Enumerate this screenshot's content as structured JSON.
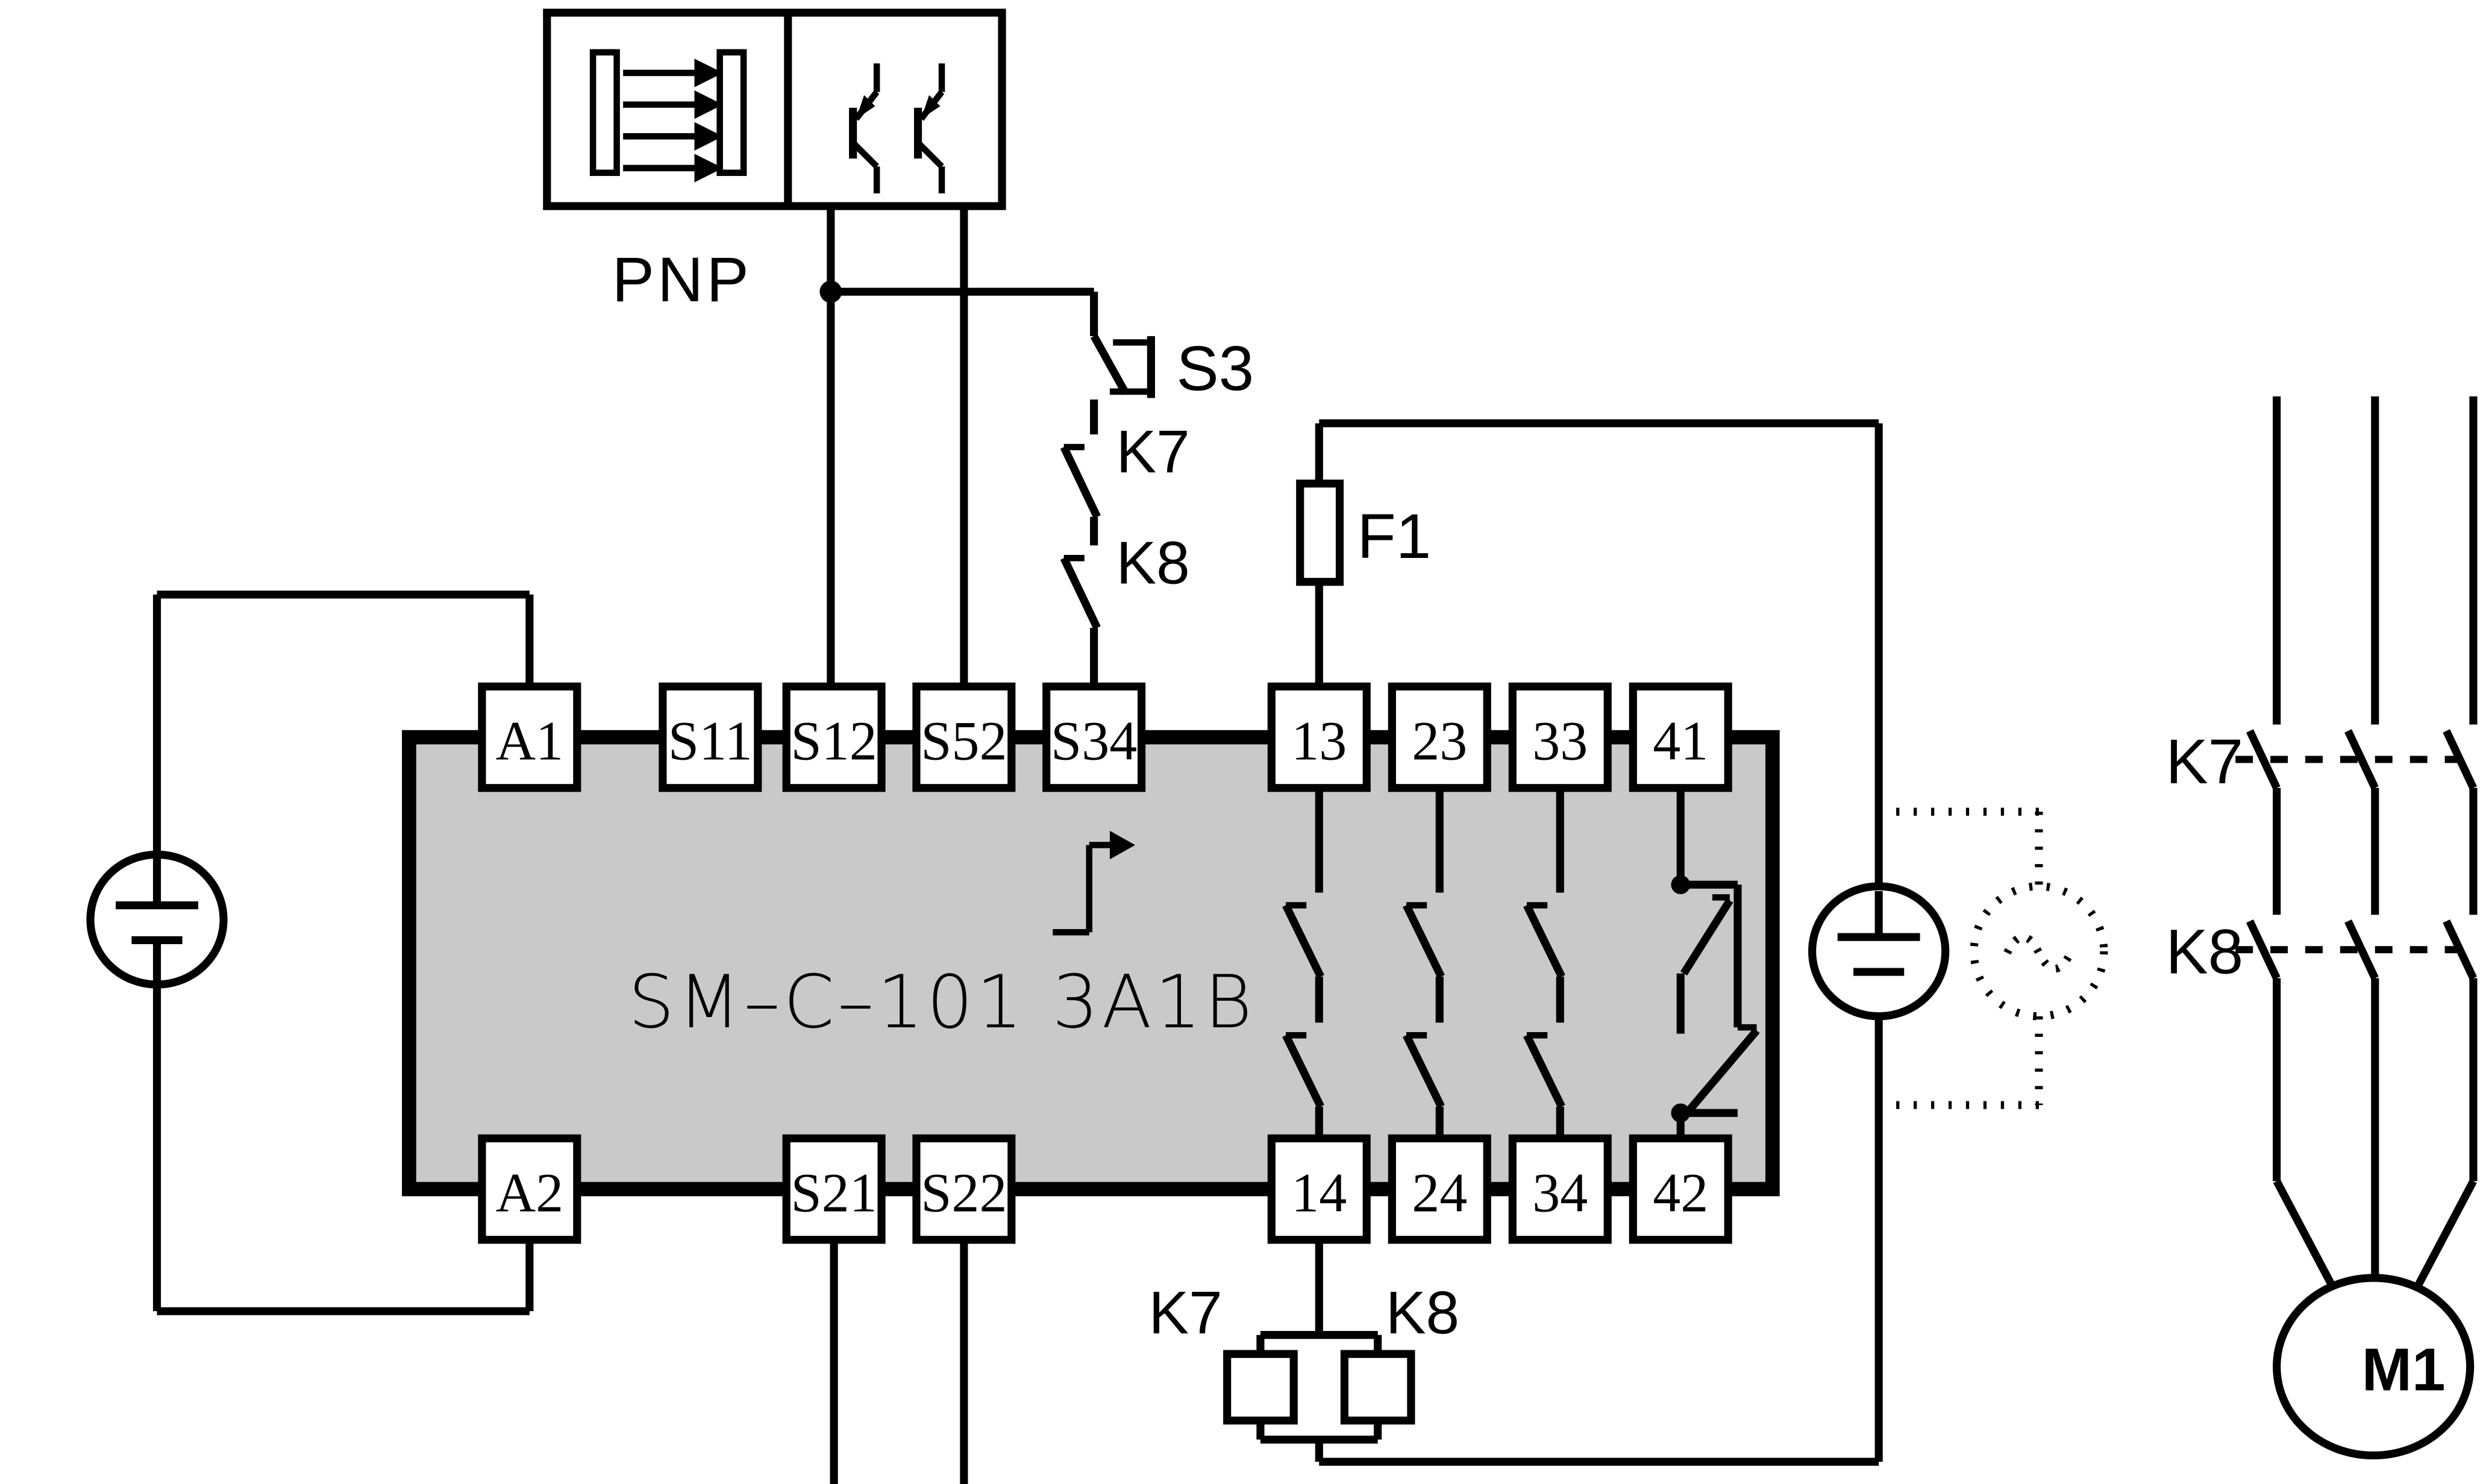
{
  "diagram": {
    "colors": {
      "background": "#ffffff",
      "line": "#000000",
      "module_fill": "#c9c9c9"
    },
    "sensor": {
      "label": "PNP"
    },
    "input_chain": {
      "s3_label": "S3",
      "k7_label": "K7",
      "k8_label": "K8"
    },
    "fuse": {
      "label": "F1"
    },
    "module": {
      "name": "SM–C–101 3A1B",
      "top_terminals": [
        "A1",
        "S11",
        "S12",
        "S52",
        "S34",
        "13",
        "23",
        "33",
        "41"
      ],
      "bottom_terminals": [
        "A2",
        "S21",
        "S22",
        "14",
        "24",
        "34",
        "42"
      ]
    },
    "coils": {
      "k7_label": "K7",
      "k8_label": "K8"
    },
    "contactors": {
      "k7_label": "K7",
      "k8_label": "K8"
    },
    "motor": {
      "label": "M1"
    }
  }
}
